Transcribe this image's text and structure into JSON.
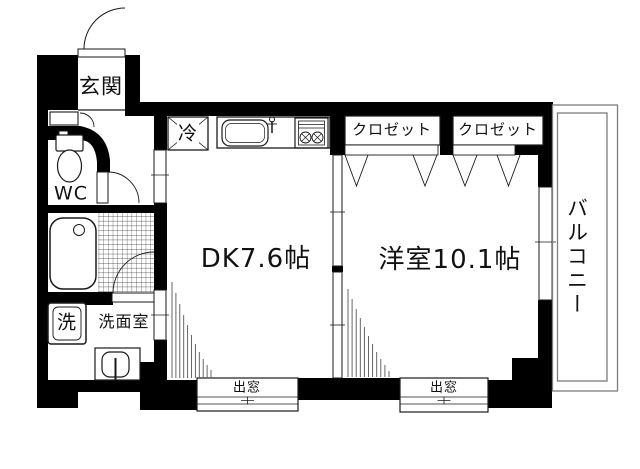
{
  "plan_type": "apartment-floorplan",
  "colors": {
    "wall": "#000000",
    "background": "#ffffff",
    "line": "#1a1a1a",
    "balcony_line": "#7d7d7d",
    "fan_line": "#555555",
    "text": "#111111"
  },
  "labels": {
    "entrance": "玄関",
    "wc": "WC",
    "refrigerator": "冷",
    "closet_left": "クロゼット",
    "closet_right": "クロゼット",
    "dining_kitchen": "DK7.6帖",
    "western_room": "洋室10.1帖",
    "balcony": "バルコニー",
    "washing_machine": "洗",
    "washroom": "洗面室",
    "bay_window_left": "出窓",
    "bay_window_right": "出窓"
  },
  "icons": {
    "toilet-icon": "tank+bowl shape",
    "bathtub-icon": "rounded rect with drain circle",
    "kitchen-sink-icon": "rounded basin with faucet",
    "gas-stove-icon": "grill box with two crossed burners",
    "refrigerator-icon": "crossed square",
    "washing-machine-icon": "double-border square",
    "washbasin-icon": "basin with tap",
    "shoe-cabinet-icon": "small cabinet with swing arc",
    "door-swing-icon": "quarter-circle arc",
    "folding-door-icon": "V mark",
    "window-icon": "double parallel lines with tick"
  }
}
